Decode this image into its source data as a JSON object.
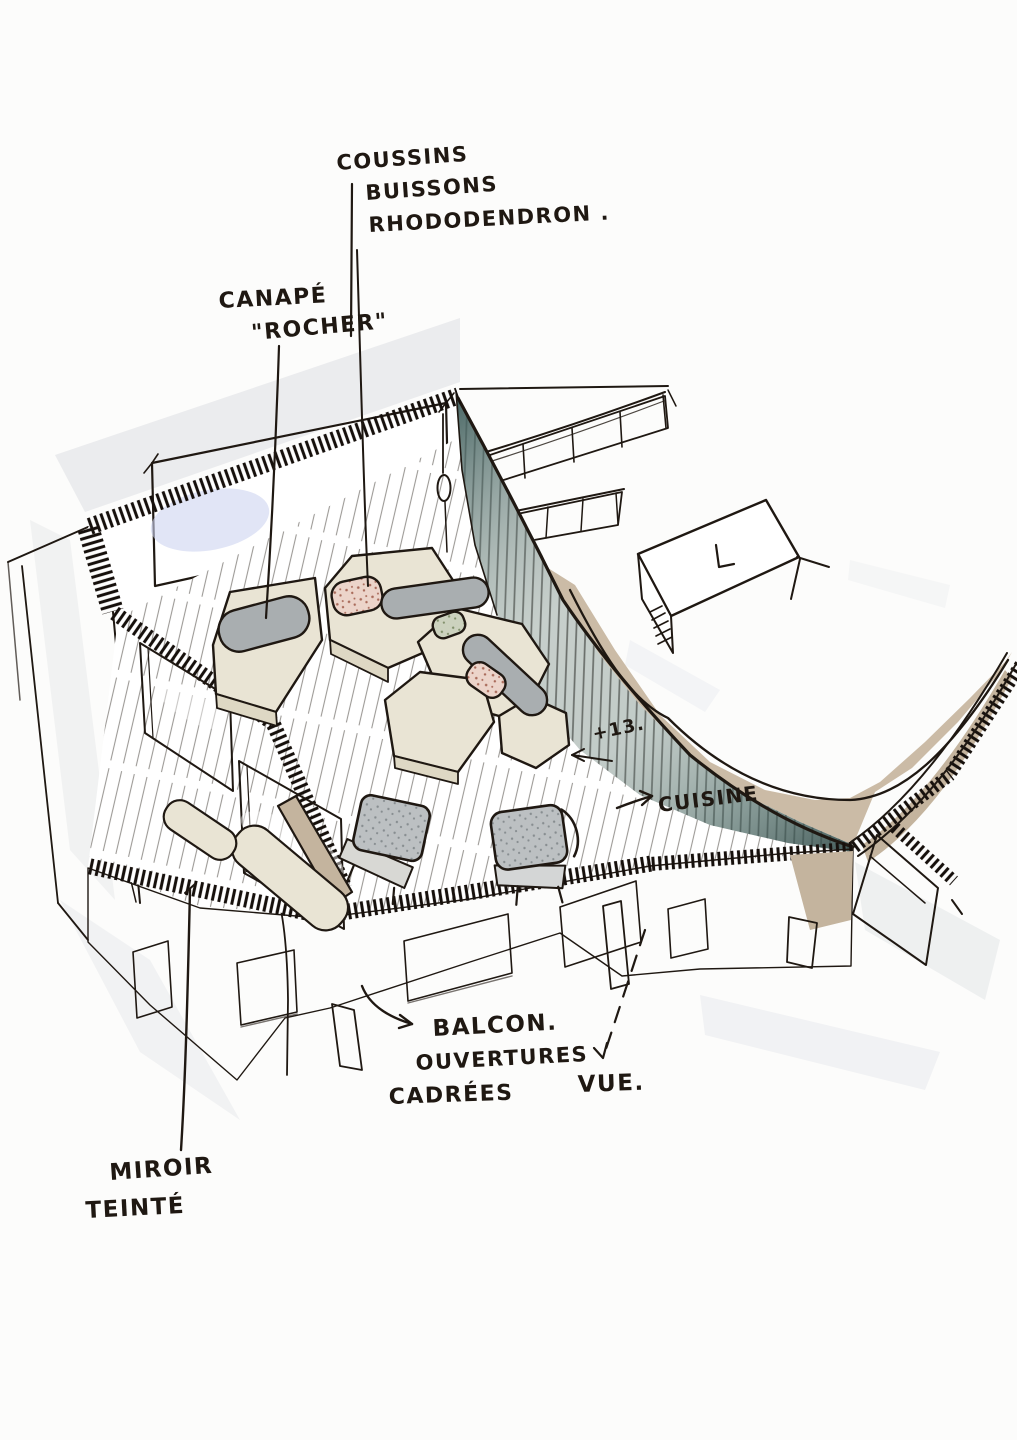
{
  "annotations": {
    "cushions": {
      "line1": "COUSSINS",
      "line2": "BUISSONS",
      "line3": "RHODODENDRON ."
    },
    "sofa": {
      "line1": "CANAPÉ",
      "line2": "\"ROCHER\""
    },
    "level_marker": "+13.",
    "kitchen": "CUISINE",
    "balcony": {
      "line1": "BALCON.",
      "line2": "OUVERTURES",
      "line3": "CADRÉES"
    },
    "view": "VUE.",
    "mirror": {
      "line1": "MIROIR",
      "line2": "TEINTÉ"
    }
  },
  "palette": {
    "ink": "#1f1812",
    "paper": "#fcfcfb",
    "glass_lavender": "#ccd3ee",
    "glass_clerestory": "#e4ecee",
    "kitchen_floor_tan": "#cbbba6",
    "stone_wall": "#b2a28c",
    "wood_frame_tan": "#b59e83",
    "sofa_cream": "#e9e4d4",
    "sofa_side_cream": "#ded8c4",
    "cushion_grey": "#a9aeb0",
    "cushion_pink": "#ecd4ca",
    "cushion_green": "#ccd2be",
    "armchair_grey": "#bcc0c2",
    "partition_teal": "#4e6a68",
    "pendant_yellow": "#f2e8bd",
    "shadow_wash": "#e9ebed"
  }
}
